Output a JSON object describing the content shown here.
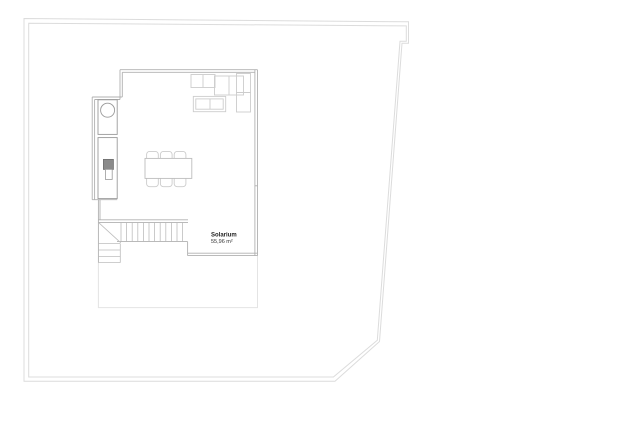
{
  "plan": {
    "room_label": {
      "name": "Solarium",
      "area": "55,96 m²"
    }
  },
  "colors": {
    "background": "#ffffff",
    "plot_boundary": "#dcdcdc",
    "building_wall": "#b0b0b0",
    "staircase": "#bdbdbd",
    "fixtures": "#9a9a9a",
    "furniture": "#cccccc",
    "terrace_outline": "#e4e4e4",
    "appliance_dark": "#8a8a8a",
    "label_text": "#222222"
  },
  "icons": {
    "sink": "circular-basin",
    "grill": "dark-square-appliance",
    "stairs": "treads-with-break-line"
  }
}
